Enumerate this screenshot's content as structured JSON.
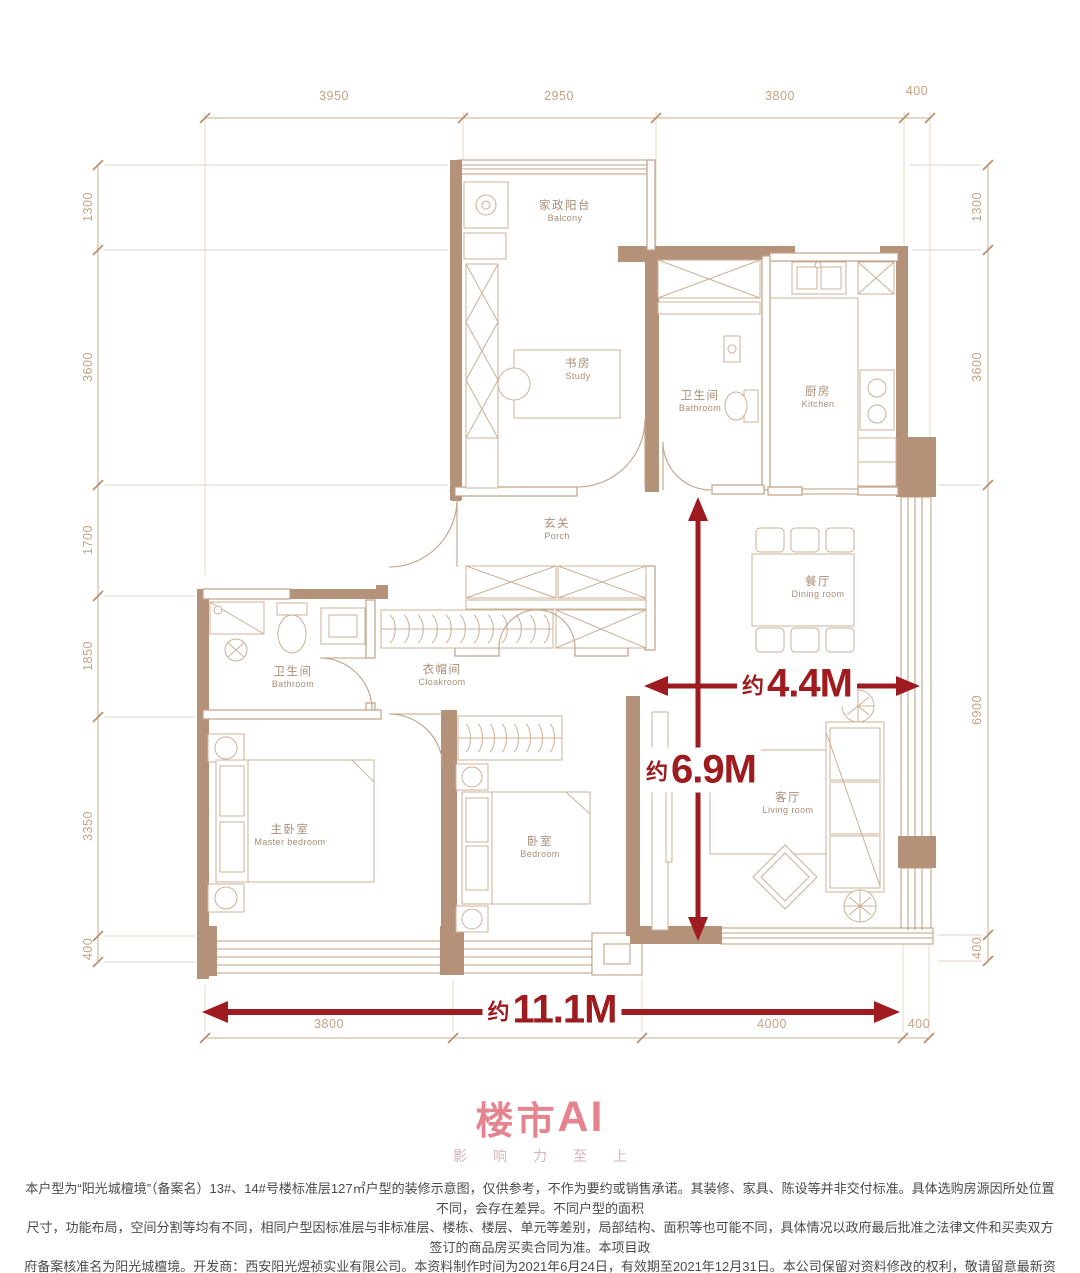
{
  "plan": {
    "rooms": [
      {
        "zh": "家政阳台",
        "en": "Balcony"
      },
      {
        "zh": "书房",
        "en": "Study"
      },
      {
        "zh": "卫生间",
        "en": "Bathroom"
      },
      {
        "zh": "厨房",
        "en": "Kitchen"
      },
      {
        "zh": "玄关",
        "en": "Porch"
      },
      {
        "zh": "餐厅",
        "en": "Dining room"
      },
      {
        "zh": "卫生间",
        "en": "Bathroom"
      },
      {
        "zh": "衣帽间",
        "en": "Cloakroom"
      },
      {
        "zh": "主卧室",
        "en": "Master bedroom"
      },
      {
        "zh": "卧室",
        "en": "Bedroom"
      },
      {
        "zh": "客厅",
        "en": "Living room"
      }
    ],
    "dims": {
      "top": [
        "3950",
        "2950",
        "3800",
        "400"
      ],
      "left": [
        "1300",
        "3600",
        "1700",
        "1850",
        "3350",
        "400"
      ],
      "right": [
        "1300",
        "3600",
        "6900",
        "400"
      ],
      "bottom": [
        "3800",
        "2900",
        "4000",
        "400"
      ]
    },
    "measurements": {
      "prefix": "约",
      "width": "4.4M",
      "depth": "6.9M",
      "total_width": "11.1M"
    }
  },
  "branding": {
    "logo_zh": "楼市",
    "logo_en": "AI",
    "slogan": "影响力至上"
  },
  "disclaimer": {
    "line1": "本户型为“阳光城檀境”（备案名）13#、14#号楼标准层127㎡户型的装修示意图，仅供参考，不作为要约或销售承诺。其装修、家具、陈设等并非交付标准。具体选购房源因所处位置不同，会存在差异。不同户型的面积",
    "line2": "尺寸，功能布局，空间分割等均有不同，相同户型因标准层与非标准层、楼栋、楼层、单元等差别，局部结构、面积等也可能不同，具体情况以政府最后批准之法律文件和买卖双方签订的商品房买卖合同为准。本项目政",
    "line3": "府备案核准名为阳光城檀境。开发商：西安阳光煜祯实业有限公司。本资料制作时间为2021年6月24日，有效期至2021年12月31日。本公司保留对资料修改的权利，敬请留意最新资料。"
  },
  "colors": {
    "wall": "#b4927a",
    "thin_line": "#c2a186",
    "dim_text": "#c2a383",
    "arrow_red": "#9e1c20",
    "logo_pink": "#e5838f"
  }
}
